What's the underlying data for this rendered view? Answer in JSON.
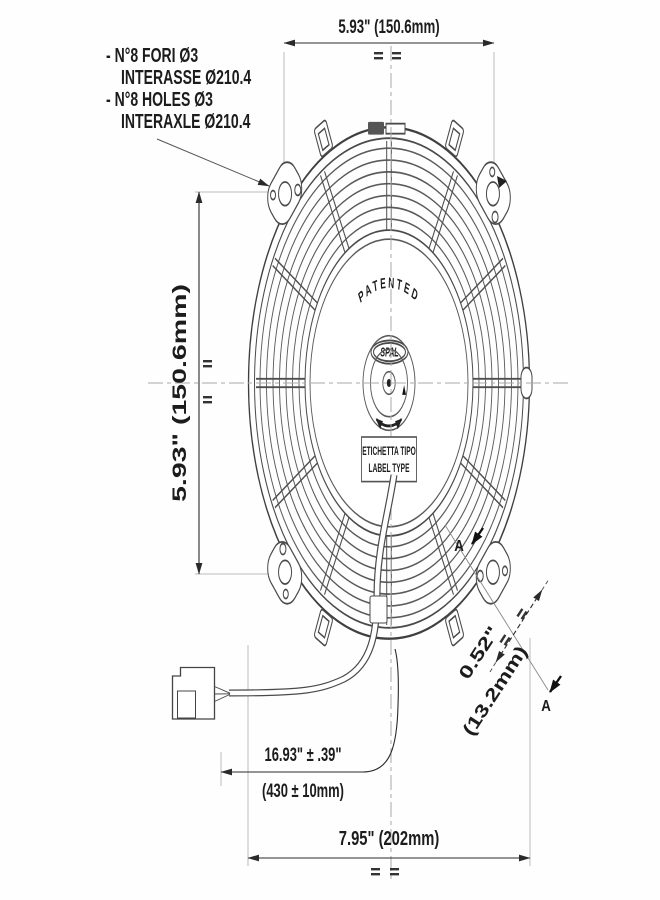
{
  "dims": {
    "top": "5.93\" (150.6mm)",
    "left": "5.93\" (150.6mm)",
    "bottom": "7.95\" (202mm)",
    "cable_in": "16.93\" ± .39\"",
    "cable_mm": "(430 ± 10mm)",
    "depth_in": "0.52\"",
    "depth_mm": "(13.2mm)"
  },
  "notes": [
    "- N°8 FORI Ø3",
    "INTERASSE Ø210.4",
    "- N°8 HOLES Ø3",
    "INTERAXLE Ø210.4"
  ],
  "section": {
    "label_a": "A"
  },
  "fan": {
    "patented": "PATENTED",
    "brand": "SPAL",
    "label_line1": "ETICHETTA TIPO",
    "label_line2": "LABEL TYPE"
  }
}
